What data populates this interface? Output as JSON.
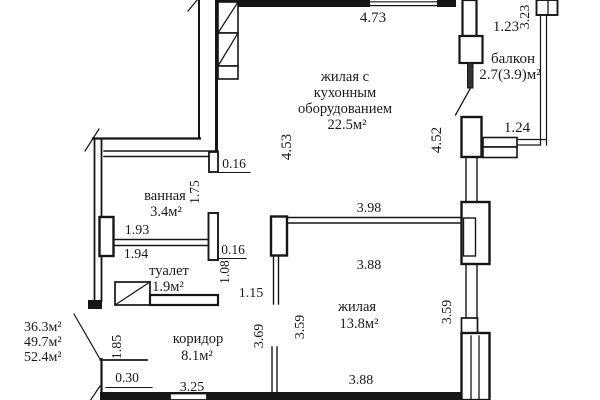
{
  "plan": {
    "rooms": {
      "living_kitchen": {
        "line1": "жилая с",
        "line2": "кухонным",
        "line3": "оборудованием",
        "area": "22.5м²"
      },
      "balcony": {
        "name": "балкон",
        "area": "2.7(3.9)м²"
      },
      "bathroom": {
        "name": "ванная",
        "area": "3.4м²"
      },
      "toilet": {
        "name": "туалет",
        "area": "1.9м²"
      },
      "corridor": {
        "name": "коридор",
        "area": "8.1м²"
      },
      "living": {
        "name": "жилая",
        "area": "13.8м²"
      }
    },
    "totals": {
      "line1": "36.3м²",
      "line2": "49.7м²",
      "line3": "52.4м²"
    },
    "dims": {
      "top_width": "4.73",
      "balcony_top": "1.23",
      "balcony_right": "3.23",
      "balcony_bottom": "1.24",
      "kitchen_left_height": "4.53",
      "kitchen_right_height": "4.52",
      "bath_stub": "0.16",
      "bath_door_height": "1.75",
      "bath_width_top": "1.93",
      "bath_width_bottom": "1.94",
      "toilet_stub": "0.16",
      "toilet_door_height": "1.08",
      "hall_width": "1.15",
      "living_top_width": "3.98",
      "living_inner_width_top": "3.88",
      "living_left_height": "3.59",
      "living_right_height": "3.59",
      "living_outer_left_height": "3.69",
      "living_inner_width_bottom": "3.88",
      "corridor_left_height": "1.85",
      "corridor_step": "0.30",
      "corridor_width": "3.25"
    },
    "line_color": "#161616"
  }
}
